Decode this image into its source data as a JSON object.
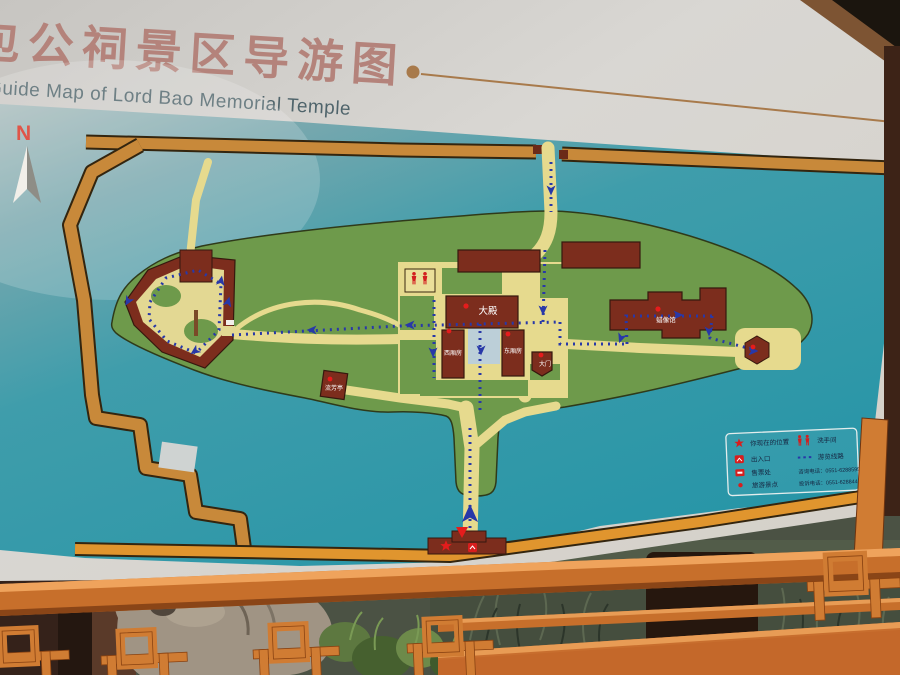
{
  "sign": {
    "title_cn": "包公祠景区导游图",
    "title_en": "Guide Map of Lord Bao Memorial Temple"
  },
  "compass": {
    "north": "N"
  },
  "map": {
    "labels": {
      "main_hall": "大殿",
      "west_wing": "西厢房",
      "east_wing": "东厢房",
      "wax_museum": "蜡像馆",
      "pavilion": "流芳亭",
      "gate": "大门"
    }
  },
  "legend": {
    "left": [
      {
        "icon": "star",
        "label": "你现在的位置"
      },
      {
        "icon": "entrance",
        "label": "出入口"
      },
      {
        "icon": "ticket",
        "label": "售票处"
      },
      {
        "icon": "dot",
        "label": "旅游景点"
      }
    ],
    "right": [
      {
        "icon": "restroom",
        "label": "洗手间"
      },
      {
        "icon": "route",
        "label": "游览线路"
      }
    ],
    "phones": [
      "咨询电话：0551-62885950",
      "投诉电话：0551-62884450"
    ]
  },
  "colors": {
    "water": "#2f9aa9",
    "island": "#6e9a4b",
    "building": "#7c2d1d",
    "path_tan": "#e6da8e",
    "shore_orange": "#c8893a",
    "route_blue": "#2838a8",
    "marker_red": "#e51c1c",
    "frame_orange": "#cf7a33",
    "title_cn": "#b4837b",
    "title_en": "#4f646b"
  }
}
